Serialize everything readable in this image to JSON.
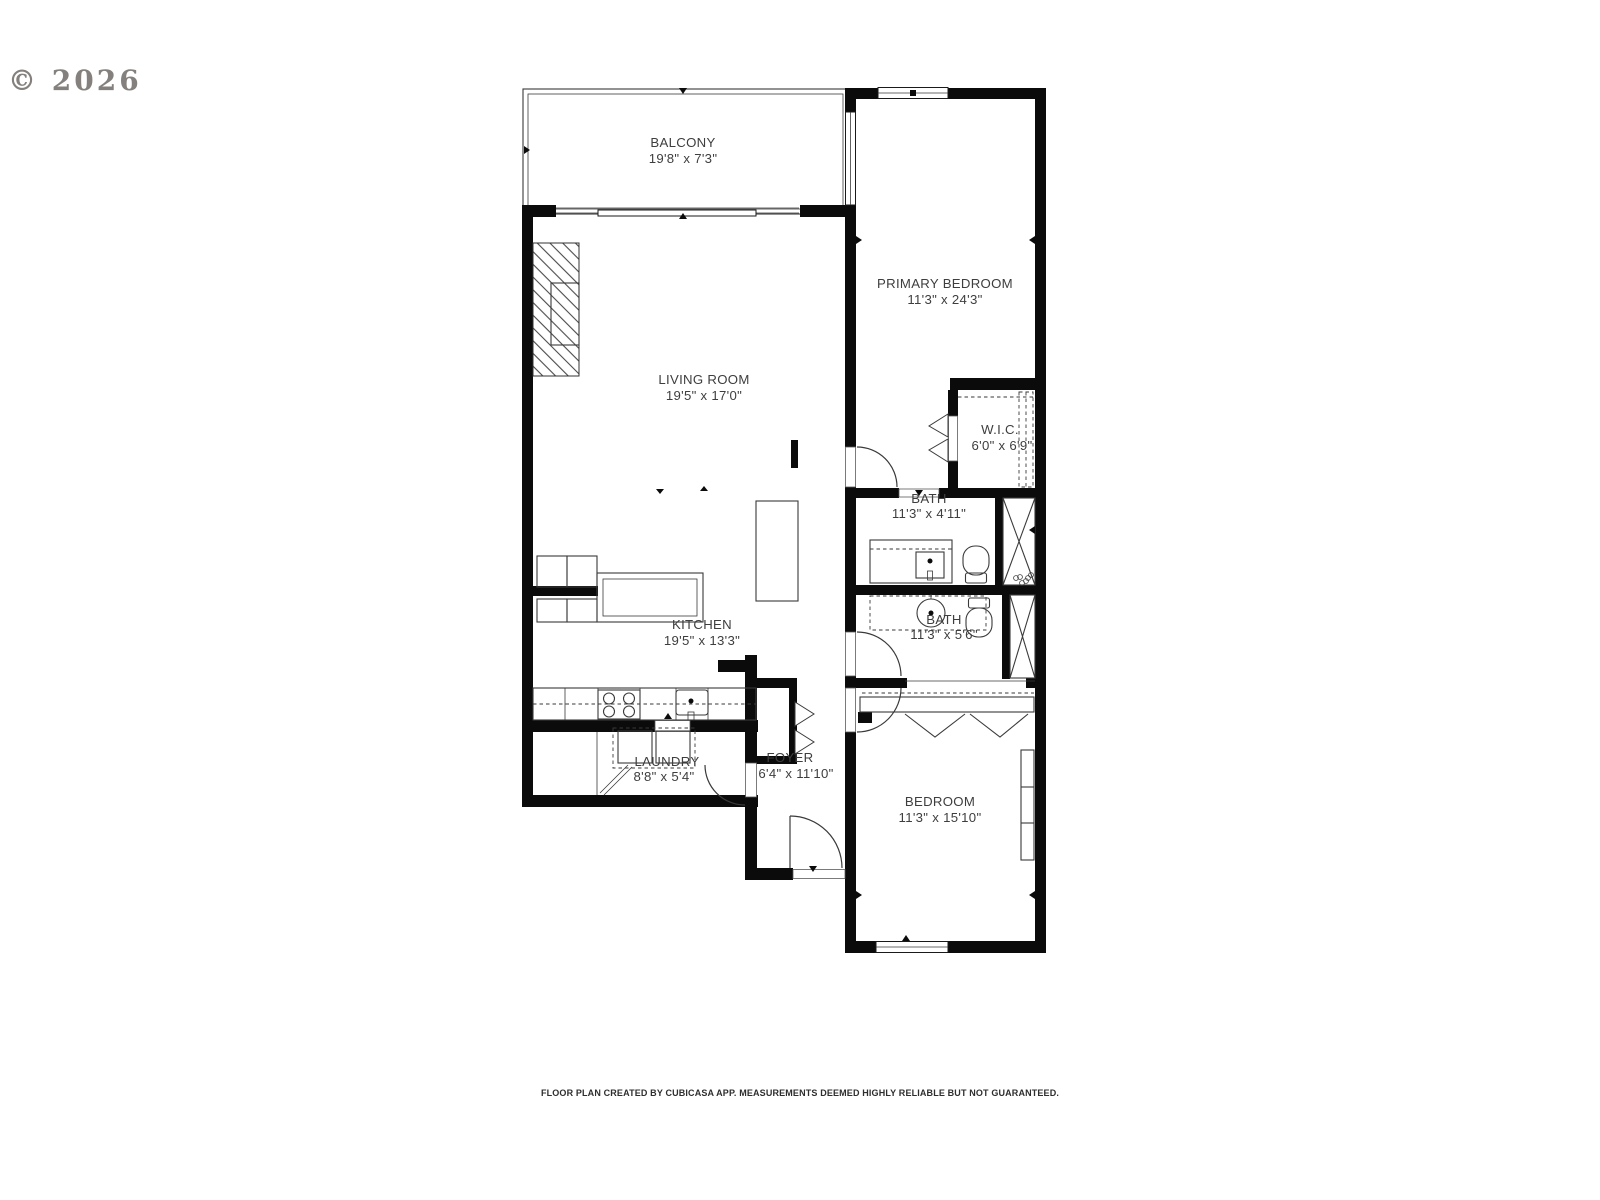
{
  "watermark": {
    "copyright": "© 2026"
  },
  "rooms": {
    "balcony": {
      "name": "BALCONY",
      "dims": "19'8\" x 7'3\""
    },
    "primary_bedroom": {
      "name": "PRIMARY BEDROOM",
      "dims": "11'3\" x 24'3\""
    },
    "living_room": {
      "name": "LIVING ROOM",
      "dims": "19'5\" x 17'0\""
    },
    "wic": {
      "name": "W.I.C.",
      "dims": "6'0\" x 6'9\""
    },
    "bath1": {
      "name": "BATH",
      "dims": "11'3\" x 4'11\""
    },
    "bath2": {
      "name": "BATH",
      "dims": "11'3\" x 5'6\""
    },
    "kitchen": {
      "name": "KITCHEN",
      "dims": "19'5\" x 13'3\""
    },
    "laundry": {
      "name": "LAUNDRY",
      "dims": "8'8\" x 5'4\""
    },
    "foyer": {
      "name": "FOYER",
      "dims": "6'4\" x 11'10\""
    },
    "bedroom": {
      "name": "BEDROOM",
      "dims": "11'3\" x 15'10\""
    }
  },
  "footer": {
    "disclaimer": "FLOOR PLAN CREATED BY CUBICASA APP. MEASUREMENTS DEEMED HIGHLY RELIABLE BUT NOT GUARANTEED."
  }
}
